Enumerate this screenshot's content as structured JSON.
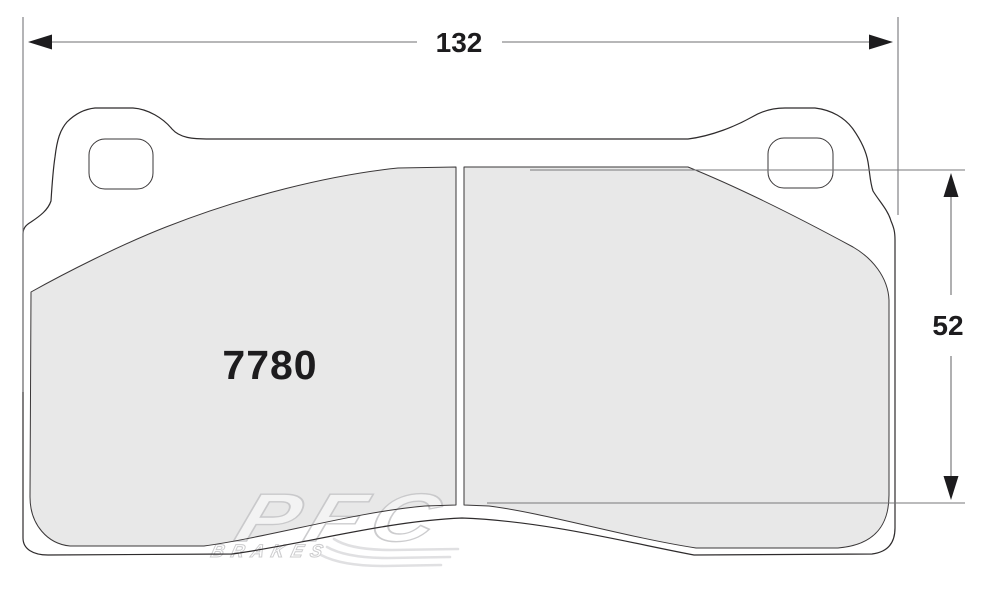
{
  "drawing": {
    "part_number": "7780",
    "width_dimension": "132",
    "height_dimension": "52"
  },
  "watermark": {
    "brand": "PFC",
    "subbrand": "BRAKES"
  },
  "colors": {
    "background": "#ffffff",
    "plate_fill": "#ffffff",
    "friction_fill": "#e8e8e8",
    "outline": "#2e2b2c",
    "dimension_line": "#6f6f71",
    "dimension_text": "#1d1c1e",
    "watermark_fill": "#ffffff",
    "watermark_stroke": "#c4c4c6"
  }
}
